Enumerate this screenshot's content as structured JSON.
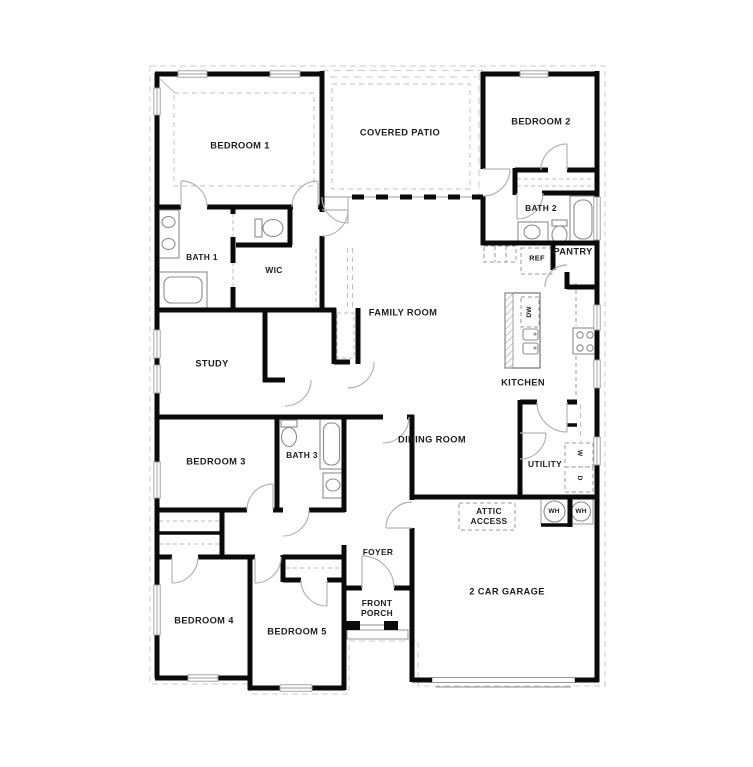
{
  "floor_plan": {
    "title": "5 bedroom single-story floor plan",
    "rooms": {
      "bedroom1": "BEDROOM 1",
      "covered_patio": "COVERED PATIO",
      "bedroom2": "BEDROOM 2",
      "bath1": "BATH 1",
      "wic": "WIC",
      "bath2": "BATH 2",
      "pantry": "PANTRY",
      "family_room": "FAMILY ROOM",
      "kitchen": "KITCHEN",
      "study": "STUDY",
      "dining_room": "DINING ROOM",
      "bedroom3": "BEDROOM 3",
      "bath3": "BATH 3",
      "utility": "UTILITY",
      "attic_access": "ATTIC\nACCESS",
      "foyer": "FOYER",
      "front_porch": "FRONT\nPORCH",
      "garage": "2 CAR GARAGE",
      "bedroom4": "BEDROOM 4",
      "bedroom5": "BEDROOM 5"
    },
    "appliances": {
      "ref": "REF",
      "dishwasher": "DW",
      "washer": "W",
      "dryer": "D",
      "water_heater_1": "WH",
      "water_heater_2": "WH"
    },
    "colors": {
      "wall": "#0a0a0a",
      "thin_line": "#8c8c8c",
      "dashed_line": "#c2c2c2",
      "door_arc": "#b3b3b3",
      "text": "#1d1d1d",
      "background": "#ffffff"
    }
  }
}
